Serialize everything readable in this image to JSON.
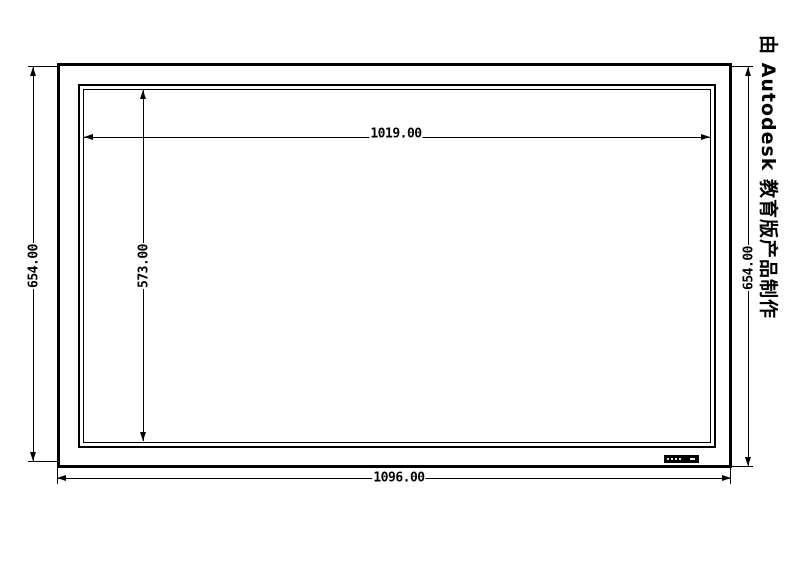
{
  "watermark": "由 Autodesk 教育版产品制作",
  "dims": {
    "inner_width": "1019.00",
    "inner_height": "573.00",
    "outer_height_left": "654.00",
    "outer_height_right": "654.00",
    "outer_width": "1096.00"
  },
  "colors": {
    "line": "#000000",
    "background": "#ffffff"
  }
}
